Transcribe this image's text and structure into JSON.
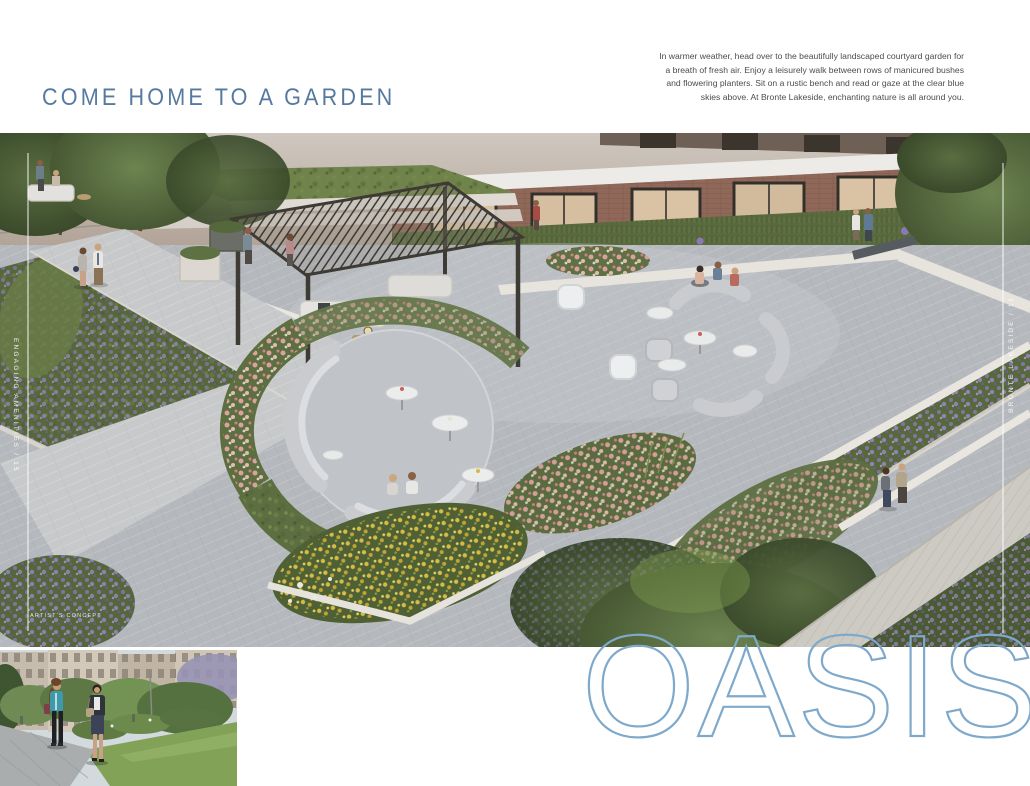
{
  "header": {
    "headline": "COME HOME TO A GARDEN"
  },
  "intro": {
    "line1": "In warmer weather, head over to the beautifully landscaped courtyard garden for",
    "line2": "a breath of fresh air. Enjoy a leisurely walk between rows of manicured bushes",
    "line3": "and flowering planters. Sit on a rustic bench and read or gaze at the clear blue",
    "line4": "skies above. At Bronte Lakeside, enchanting nature is all around you."
  },
  "hero": {
    "left_edge_label": "ENGAGING AMENITIES / 15",
    "right_edge_label": "BRONTE LAKESIDE / 11",
    "caption": "ARTIST'S CONCEPT"
  },
  "wordmark": {
    "text": "OASIS"
  },
  "colors": {
    "headline_blue": "#567a9f",
    "body_text": "#4c4c4c",
    "wordmark_blue": "#7fa9cb",
    "edge_label_white": "#ffffff"
  }
}
